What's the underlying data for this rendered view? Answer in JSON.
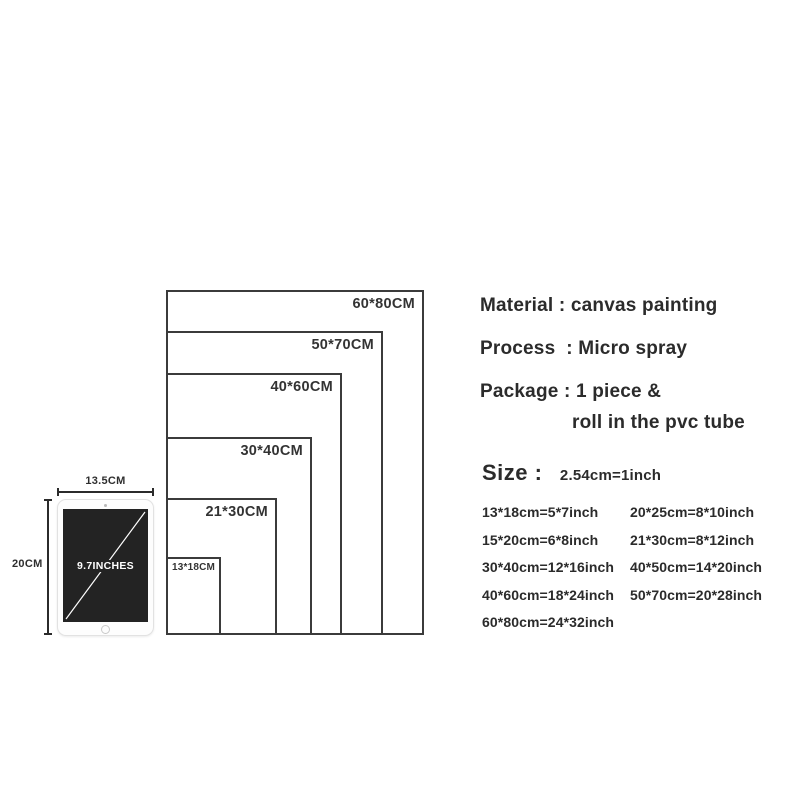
{
  "colors": {
    "text": "#2b2b2b",
    "rect_border": "#3b3b3b",
    "screen_bg": "#232323",
    "tablet_bezel": "#fdfdfd"
  },
  "diagram": {
    "rects": [
      {
        "label": "60*80CM"
      },
      {
        "label": "50*70CM"
      },
      {
        "label": "40*60CM"
      },
      {
        "label": "30*40CM"
      },
      {
        "label": "21*30CM"
      },
      {
        "label": "13*18CM"
      }
    ],
    "tablet": {
      "screen_label": "9.7INCHES",
      "width_label": "13.5CM",
      "height_label": "20CM"
    }
  },
  "details": {
    "material_line": "Material : canvas painting",
    "process_line": "Process  : Micro spray",
    "package_line1": "Package : 1 piece &",
    "package_line2": "roll in the pvc tube",
    "size_heading": "Size :",
    "size_conversion_note": "2.54cm=1inch"
  },
  "size_table": {
    "rows": [
      [
        "13*18cm=5*7inch",
        "20*25cm=8*10inch"
      ],
      [
        "15*20cm=6*8inch",
        "21*30cm=8*12inch"
      ],
      [
        "30*40cm=12*16inch",
        "40*50cm=14*20inch"
      ],
      [
        "40*60cm=18*24inch",
        "50*70cm=20*28inch"
      ],
      [
        "60*80cm=24*32inch",
        ""
      ]
    ]
  }
}
